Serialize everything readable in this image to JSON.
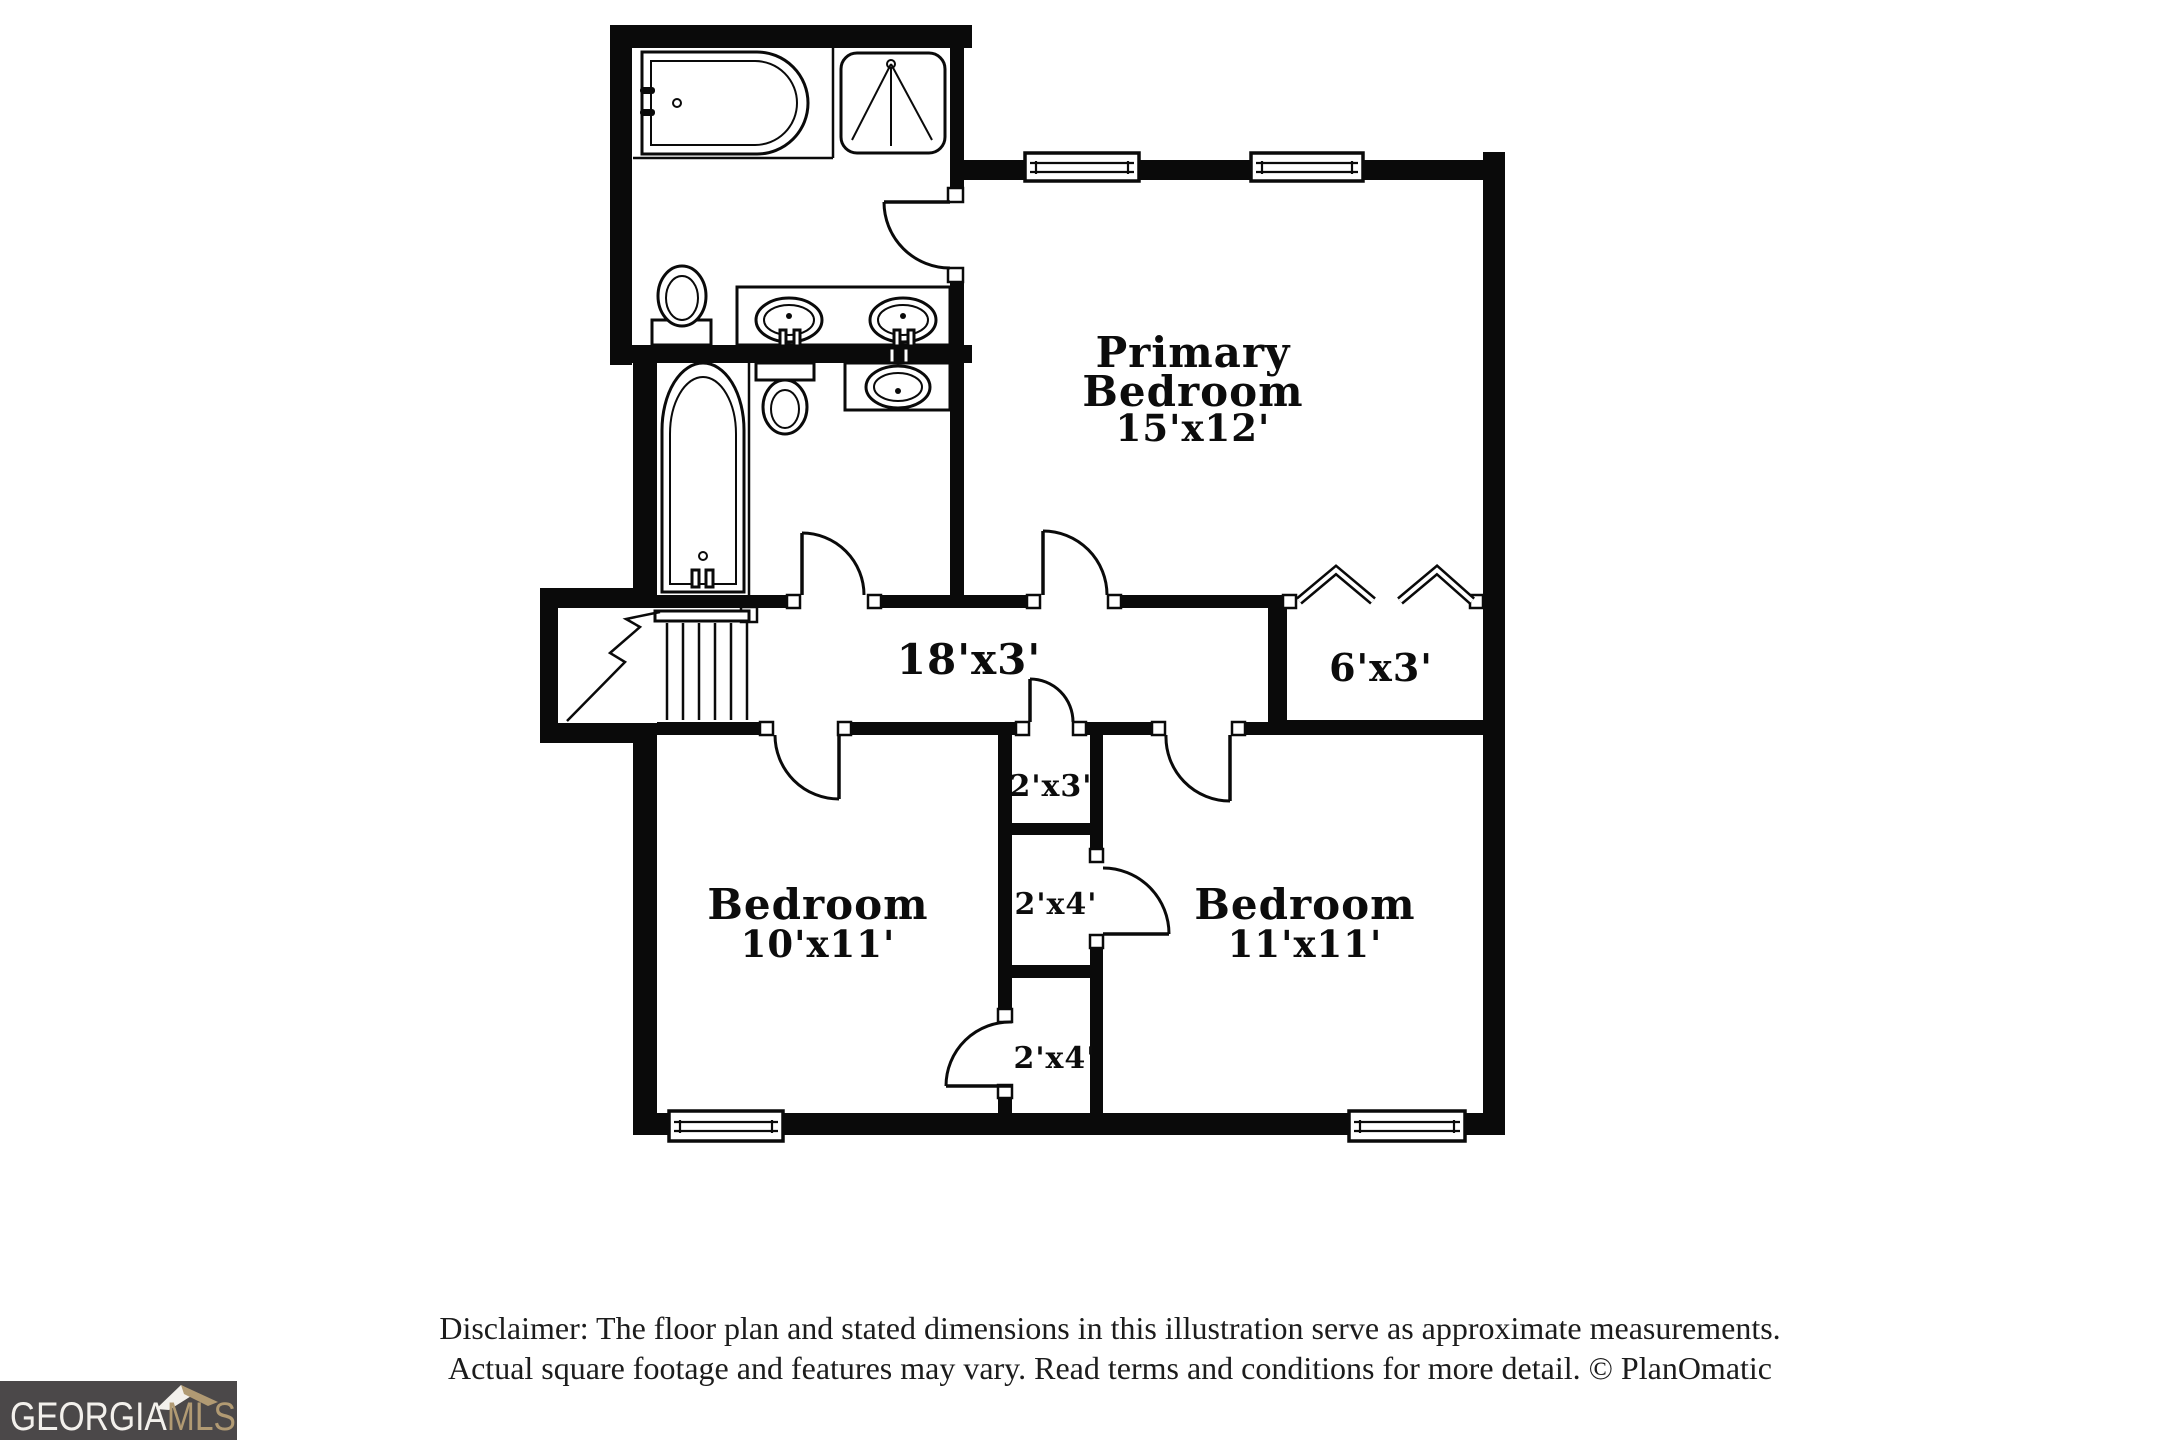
{
  "colors": {
    "background": "#ffffff",
    "wall": "#0a0a0a",
    "logo_background": "#4b4849",
    "logo_gold": "#b19a73",
    "logo_white": "#f3f0ec"
  },
  "plan": {
    "rooms": [
      {
        "name": "Primary Bedroom",
        "dimensions": "15'x12'"
      },
      {
        "name": "Bedroom",
        "dimensions": "10'x11'"
      },
      {
        "name": "Bedroom",
        "dimensions": "11'x11'"
      },
      {
        "name": "Hallway",
        "dimensions": "18'x3'"
      },
      {
        "name": "Closet",
        "dimensions": "6'x3'"
      },
      {
        "name": "Closet",
        "dimensions": "2'x3'"
      },
      {
        "name": "Closet",
        "dimensions": "2'x4'"
      },
      {
        "name": "Closet",
        "dimensions": "2'x4'"
      }
    ],
    "labels": {
      "primary_line1": "Primary",
      "primary_line2": "Bedroom",
      "primary_dim": "15'x12'",
      "hallway_dim": "18'x3'",
      "primary_closet_dim": "6'x3'",
      "left_bedroom_name": "Bedroom",
      "left_bedroom_dim": "10'x11'",
      "right_bedroom_name": "Bedroom",
      "right_bedroom_dim": "11'x11'",
      "closet_2x3_dim": "2'x3'",
      "closet_2x4_mid_dim": "2'x4'",
      "closet_2x4_bottom_dim": "2'x4'"
    },
    "fixtures": [
      "bathtub",
      "shower",
      "toilet",
      "double-vanity sinks",
      "bathtub",
      "toilet",
      "sink",
      "staircase",
      "windows",
      "bifold closet doors",
      "door swings"
    ]
  },
  "footer": {
    "disclaimer_line1": "Disclaimer: The floor plan and stated dimensions in this illustration serve as approximate measurements.",
    "disclaimer_line2": "Actual square footage and features may vary. Read terms and conditions for more detail. © PlanOmatic"
  },
  "logo": {
    "text_primary": "GEORGIA",
    "text_secondary": "MLS"
  }
}
